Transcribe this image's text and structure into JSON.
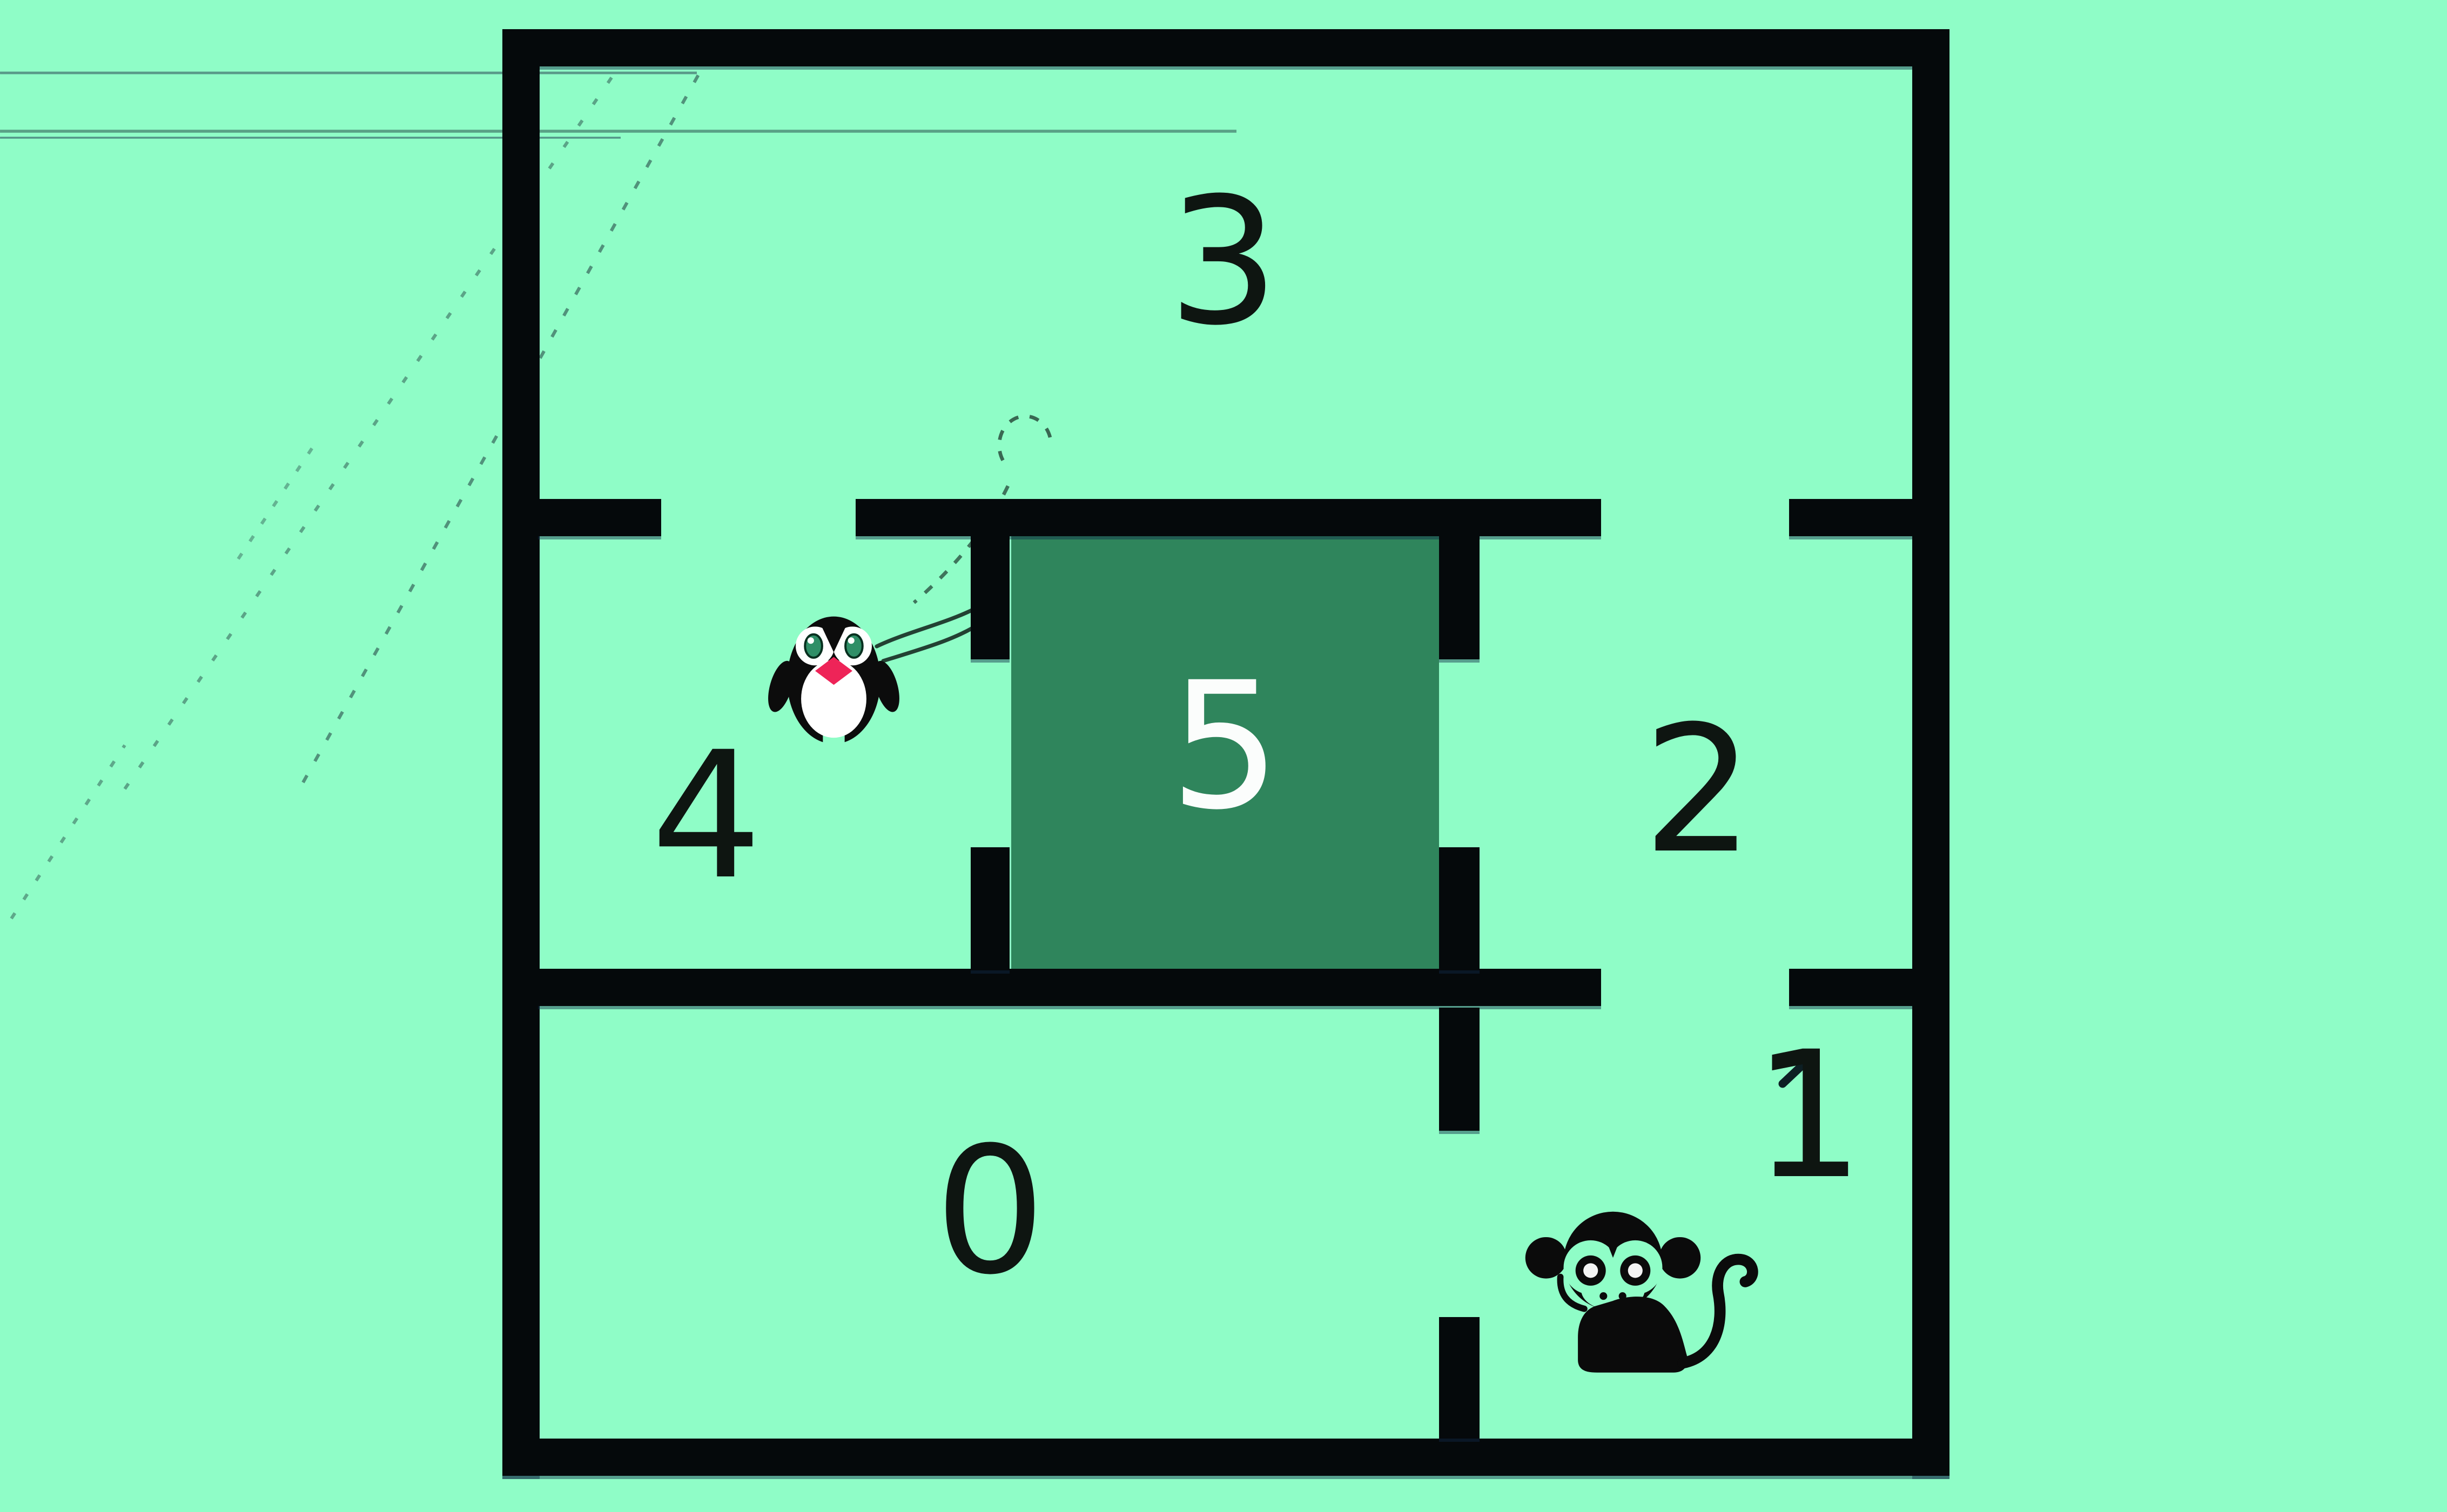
{
  "title": "maze-floorplan",
  "colors": {
    "bg": "#8FFDC7",
    "wall": "#05090B",
    "room5": "#2F855C",
    "label": "#0E1511",
    "label_light": "#FBFDFC",
    "beak": "#EE2458",
    "eye": "#2F8F67",
    "sketch": "#16323C"
  },
  "maze": {
    "rooms": [
      {
        "id": "0",
        "label": "0"
      },
      {
        "id": "1",
        "label": "1"
      },
      {
        "id": "2",
        "label": "2"
      },
      {
        "id": "3",
        "label": "3"
      },
      {
        "id": "4",
        "label": "4"
      },
      {
        "id": "5",
        "label": "5"
      }
    ]
  },
  "characters": [
    {
      "id": "penguin",
      "location_room": "4"
    },
    {
      "id": "monkey",
      "location_room": "1"
    }
  ]
}
